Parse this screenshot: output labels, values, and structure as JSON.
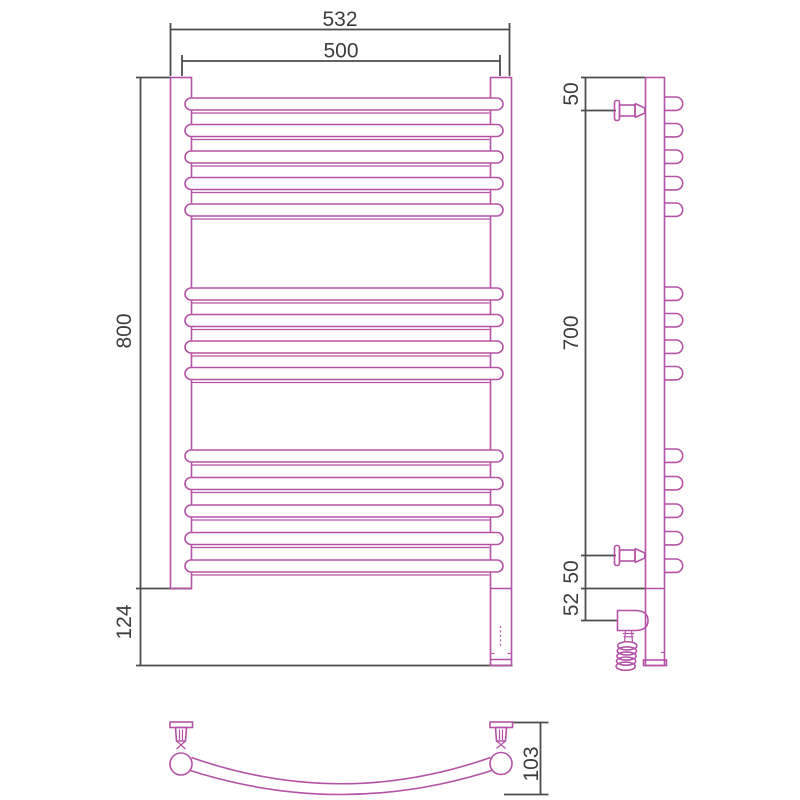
{
  "drawing": {
    "background": "#ffffff",
    "outline_color": "#b552a6",
    "dimension_color": "#4c4c4c",
    "bar_count": 14,
    "bar_groups": [
      5,
      4,
      5
    ]
  },
  "dimensions": {
    "front": {
      "overall_width": "532",
      "axis_width": "500",
      "height": "800",
      "lower_height": "124"
    },
    "side": {
      "top_offset": "50",
      "bracket_span": "700",
      "bottom_offset": "50",
      "heater_offset": "52"
    },
    "bottom": {
      "depth": "103"
    }
  }
}
